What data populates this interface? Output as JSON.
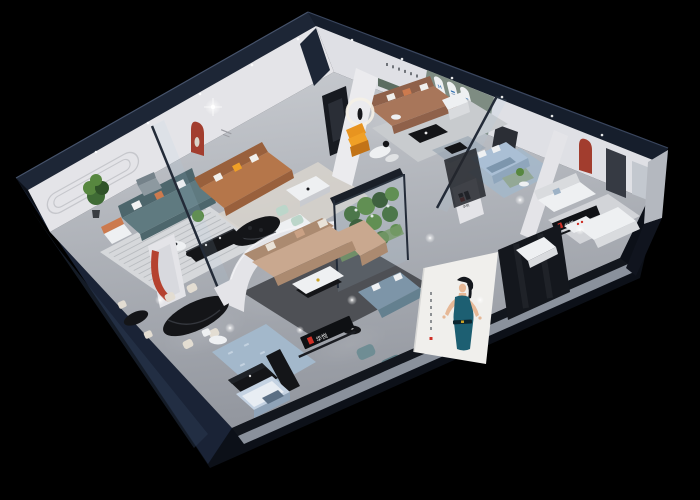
{
  "scene": {
    "title": "3D isometric cutaway render of a furniture showroom on black background",
    "view": "dollhouse aerial perspective"
  },
  "brand": {
    "name": "华悦",
    "logo_mark": "black-and-red squared H monogram",
    "sign_text_color": "#e8e8e8"
  },
  "archGallery": {
    "logoLetter": "M",
    "archCount": "3",
    "logoColor": "#2b6cb0"
  },
  "poster": {
    "subject": "woman in teal halter dress",
    "sideText": "vertical illegible characters",
    "sealColor": "#c03028"
  },
  "palette": {
    "bg": "#000000",
    "shell": "#0c1018",
    "navyBand": "#1d2636",
    "navyBand2": "#161e2c",
    "navyLeft": "#1a2336",
    "navyLeftHi": "#2d3b55",
    "wall": "#e4e4e8",
    "wallSh": "#d2d3d9",
    "wallNe": "#dfe0e5",
    "floorHi": "#c9ccd1",
    "floorLo": "#93979f",
    "slab": "#8a919c",
    "shadowStrip": "#12161d",
    "greenWall": "#7e8c82",
    "greenNiche": "#5b6d61",
    "red": "#a23d2e",
    "redStrip": "#b5422f",
    "logoRed": "#cf2f26",
    "tealSofa": "#5f7a80",
    "tealSofaDk": "#4d666c",
    "caramel": "#b5764a",
    "caramelDk": "#99603c",
    "brown": "#a8765a",
    "brownDk": "#8f614a",
    "tan": "#c9a88f",
    "tanDk": "#ab8a70",
    "blueSofa": "#7d95a8",
    "blueSofaDk": "#64808f",
    "ltBlue": "#aabfd5",
    "ltBlueDk": "#8fa6bc",
    "mint": "#bcd6ca",
    "greenBench": "#93a896",
    "orange": "#e8941f",
    "orangeSoft": "#cc7a4e",
    "yellow": "#f0a026",
    "blackFurn": "#141518",
    "blackHi": "#33363c",
    "whiteFurn": "#eef0f2",
    "whiteSh": "#d9dbde",
    "cream": "#e3ddd2",
    "rugLight": "#d6d8db",
    "rugStripe": "#b9bcc0",
    "rugDark": "#4e5055",
    "rugBlue": "#a3b8cb",
    "plant": "#3f6b35",
    "plantHi": "#57873f",
    "plantDk": "#2f5228",
    "glassTint": "rgba(175,205,230,0.12)",
    "frame": "#232b38",
    "poster": "#f0efec",
    "skin": "#e6b896",
    "hair": "#14171c",
    "dress": "#1d5f72",
    "archBlue": "#2b6cb0",
    "door": "#363a43",
    "postGray": "#b4b8bf",
    "grooveLine": "#c6c7cc"
  }
}
